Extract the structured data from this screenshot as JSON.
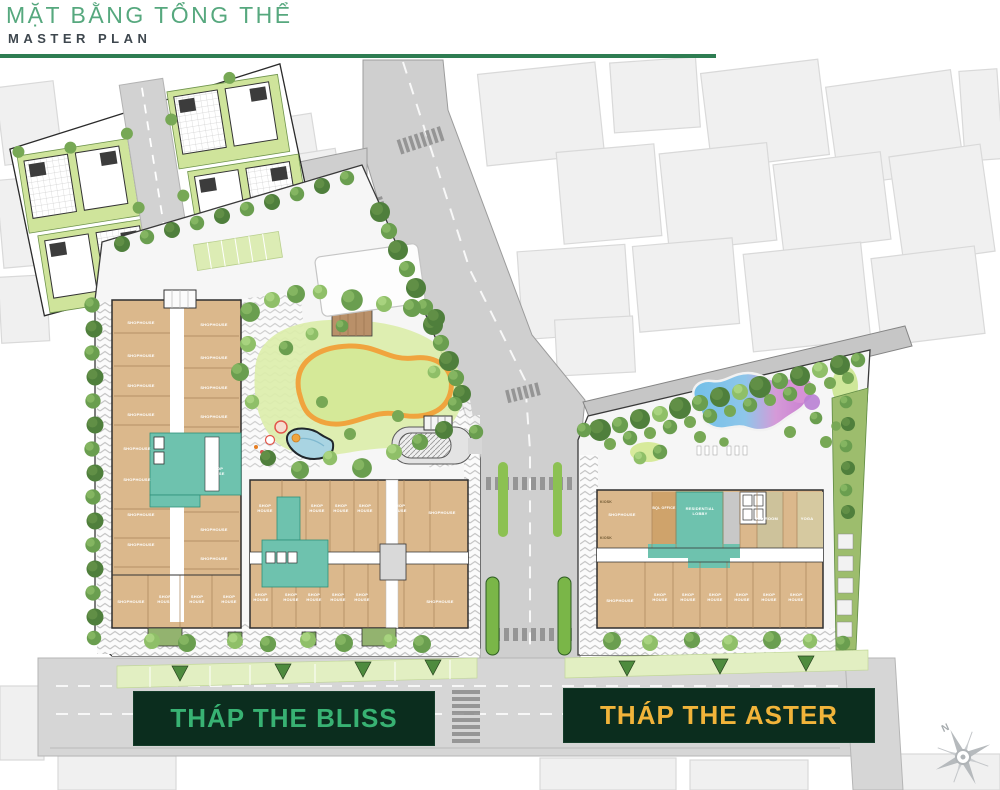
{
  "header": {
    "title": "MẶT BẰNG TỔNG THỂ",
    "subtitle": "MASTER PLAN"
  },
  "banners": {
    "bliss": "THÁP THE BLISS",
    "aster": "THÁP THE ASTER"
  },
  "compass": {
    "north": "N"
  },
  "unit_labels": {
    "shophouse": "SHOPHOUSE",
    "shop_house": "SHOP HOUSE",
    "kiosk": "KIOSK"
  },
  "rooms": {
    "office": "BQL OFFICE",
    "residential_lobby": "RESIDENTIAL LOBBY",
    "kid_room": "KID ROOM",
    "yoga": "YOGA"
  },
  "colors": {
    "title_green": "#56a87e",
    "rule_green": "#2e7d52",
    "subtitle_gray": "#3e474e",
    "banner_bg": "#0b2d1e",
    "bliss_text": "#38b273",
    "aster_text": "#f1b43a",
    "building_tan": "#dbb88c",
    "core_teal": "#6ec2ae",
    "lawn_green": "#d7ea9b",
    "pool_blue": "#7fc3e6",
    "pool_pink": "#dd9ed2",
    "path_orange": "#f0a43e"
  }
}
